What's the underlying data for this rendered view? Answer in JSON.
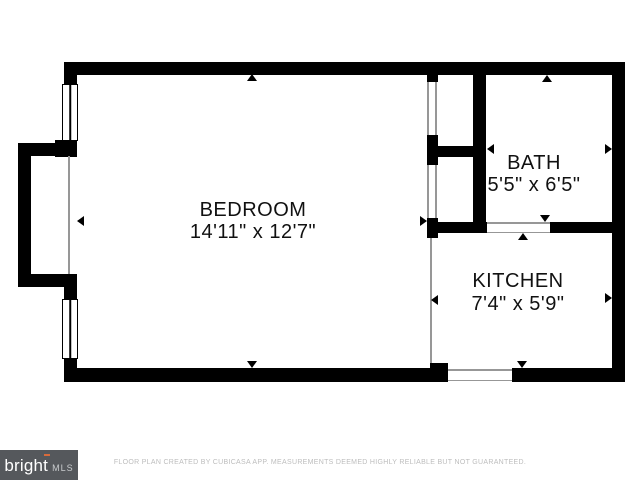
{
  "plan": {
    "rooms": [
      {
        "id": "bedroom",
        "name": "BEDROOM",
        "dims": "14'11\" x 12'7\""
      },
      {
        "id": "bath",
        "name": "BATH",
        "dims": "5'5\" x 6'5\""
      },
      {
        "id": "kitchen",
        "name": "KITCHEN",
        "dims": "7'4\" x 5'9\""
      }
    ]
  },
  "footer": {
    "logo_brand": "bright",
    "logo_suffix": "MLS",
    "disclaimer": "FLOOR PLAN CREATED BY CUBICASA APP. MEASUREMENTS DEEMED HIGHLY RELIABLE BUT NOT GUARANTEED."
  },
  "colors": {
    "wall": "#000000",
    "background": "#FFFFFF",
    "thin_line": "#979797",
    "label_text": "#111111",
    "logo_background": "#55585C",
    "logo_accent": "#D96B3C",
    "disclaimer_text": "#BDBDBD"
  }
}
